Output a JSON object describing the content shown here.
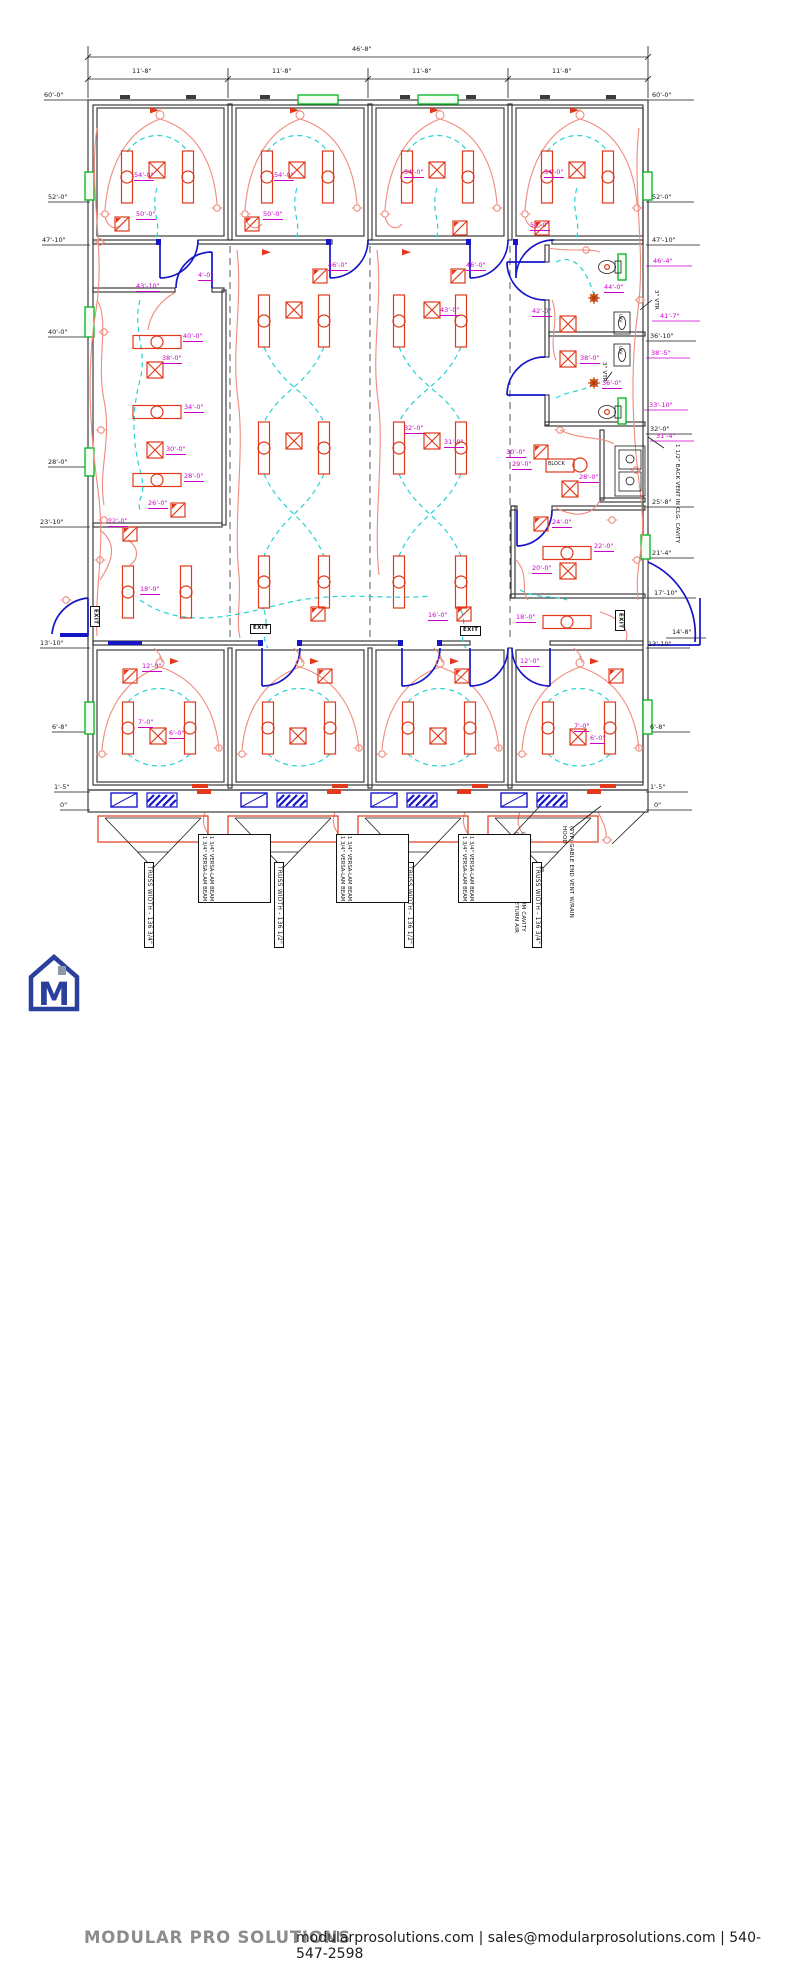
{
  "dims": {
    "overall": "46'-8\"",
    "bays": [
      "11'-8\"",
      "11'-8\"",
      "11'-8\"",
      "11'-8\""
    ],
    "left": [
      "60'-0\"",
      "52'-0\"",
      "47'-10\"",
      "40'-0\"",
      "28'-0\"",
      "23'-10\"",
      "13'-10\"",
      "6'-8\"",
      "1'-5\"",
      "0\""
    ],
    "right_black": [
      "60'-0\"",
      "52'-0\"",
      "47'-10\"",
      "36'-10\"",
      "32'-0\"",
      "25'-8\"",
      "21'-4\"",
      "17'-10\"",
      "14'-8\"",
      "13'-10\"",
      "6'-8\"",
      "1'-5\"",
      "0\""
    ],
    "right_magenta": [
      "46'-4\"",
      "41'-7\"",
      "38'-5\"",
      "33'-10\"",
      "31'-4\""
    ]
  },
  "plan_labels": [
    "54'-0\"",
    "50'-0\"",
    "54'-0\"",
    "50'-0\"",
    "54'-0\"",
    "54'-0\"",
    "50'-0\"",
    "46'-0\"",
    "46'-0\"",
    "43'-10\"",
    "4'-0\"",
    "43'-0\"",
    "40'-0\"",
    "38'-0\"",
    "34'-0\"",
    "30'-0\"",
    "28'-0\"",
    "26'-0\"",
    "32'-0\"",
    "31'-0\"",
    "44'-0\"",
    "42'-0\"",
    "38'-0\"",
    "36'-0\"",
    "30'-0\"",
    "29'-0\"",
    "BLOCK",
    "28'-0\"",
    "24'-0\"",
    "22'-0\"",
    "20'-0\"",
    "18'-0\"",
    "16'-0\"",
    "22'-0\"",
    "18'-0\"",
    "12'-0\"",
    "7'-0\"",
    "6'-0\"",
    "12'-0\"",
    "7'-0\"",
    "6'-0\""
  ],
  "exit": "EXIT",
  "misc": {
    "lav": "LAV"
  },
  "notes": {
    "vtr": "3\" VTR",
    "back_vent": "1 1/2\" BACK VENT IN CLG. CAVITY",
    "plenum": "(TYP) CUT OUT IN PLENUM CAVITY CEILING FOR DUCTED RETURN AIR",
    "gable": "(TYP) GABLE END VENT W/RAIN HOOD",
    "beam": "1 3/4\" VERSA-LAM BEAM",
    "truss": [
      "TRUSS WIDTH - 136 3/4\"",
      "TRUSS WIDTH - 136 1/2\"",
      "TRUSS WIDTH - 136 1/2\"",
      "TRUSS WIDTH - 136 3/4\""
    ]
  },
  "footer": {
    "brand": "MODULAR PRO SOLUTIONS",
    "contact": "modularprosolutions.com | sales@modularprosolutions.com | 540-547-2598",
    "logo_letter": "M"
  }
}
